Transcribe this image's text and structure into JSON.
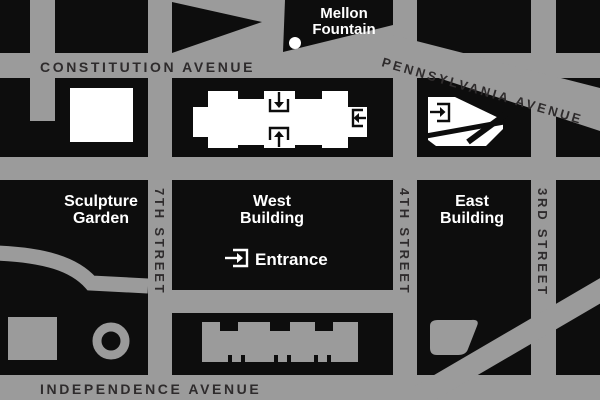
{
  "map": {
    "title": "National Gallery area wayfinding map",
    "streets": {
      "constitution": "CONSTITUTION AVENUE",
      "independence": "INDEPENDENCE AVENUE",
      "pennsylvania": "PENNSYLVANIA AVENUE",
      "seventh": "7TH STREET",
      "fourth": "4TH STREET",
      "third": "3RD STREET"
    },
    "labels": {
      "mellon_line1": "Mellon",
      "mellon_line2": "Fountain",
      "sculpture_line1": "Sculpture",
      "sculpture_line2": "Garden",
      "west_line1": "West",
      "west_line2": "Building",
      "east_line1": "East",
      "east_line2": "Building",
      "entrance": "Entrance"
    },
    "icons": {
      "entrance_icon": "arrow-into-doorway",
      "west_top_icon": "down-arrow-entrance",
      "west_bottom_icon": "up-arrow-entrance",
      "west_right_icon": "left-arrow-entrance",
      "east_door_icon": "right-arrow-entrance",
      "fountain_dot": "mellon-fountain-marker"
    },
    "colors": {
      "background_block": "#0d0d0d",
      "street_gray": "#9b9b9b",
      "street_text": "#2e2b2c",
      "feature_white": "#ffffff"
    }
  }
}
